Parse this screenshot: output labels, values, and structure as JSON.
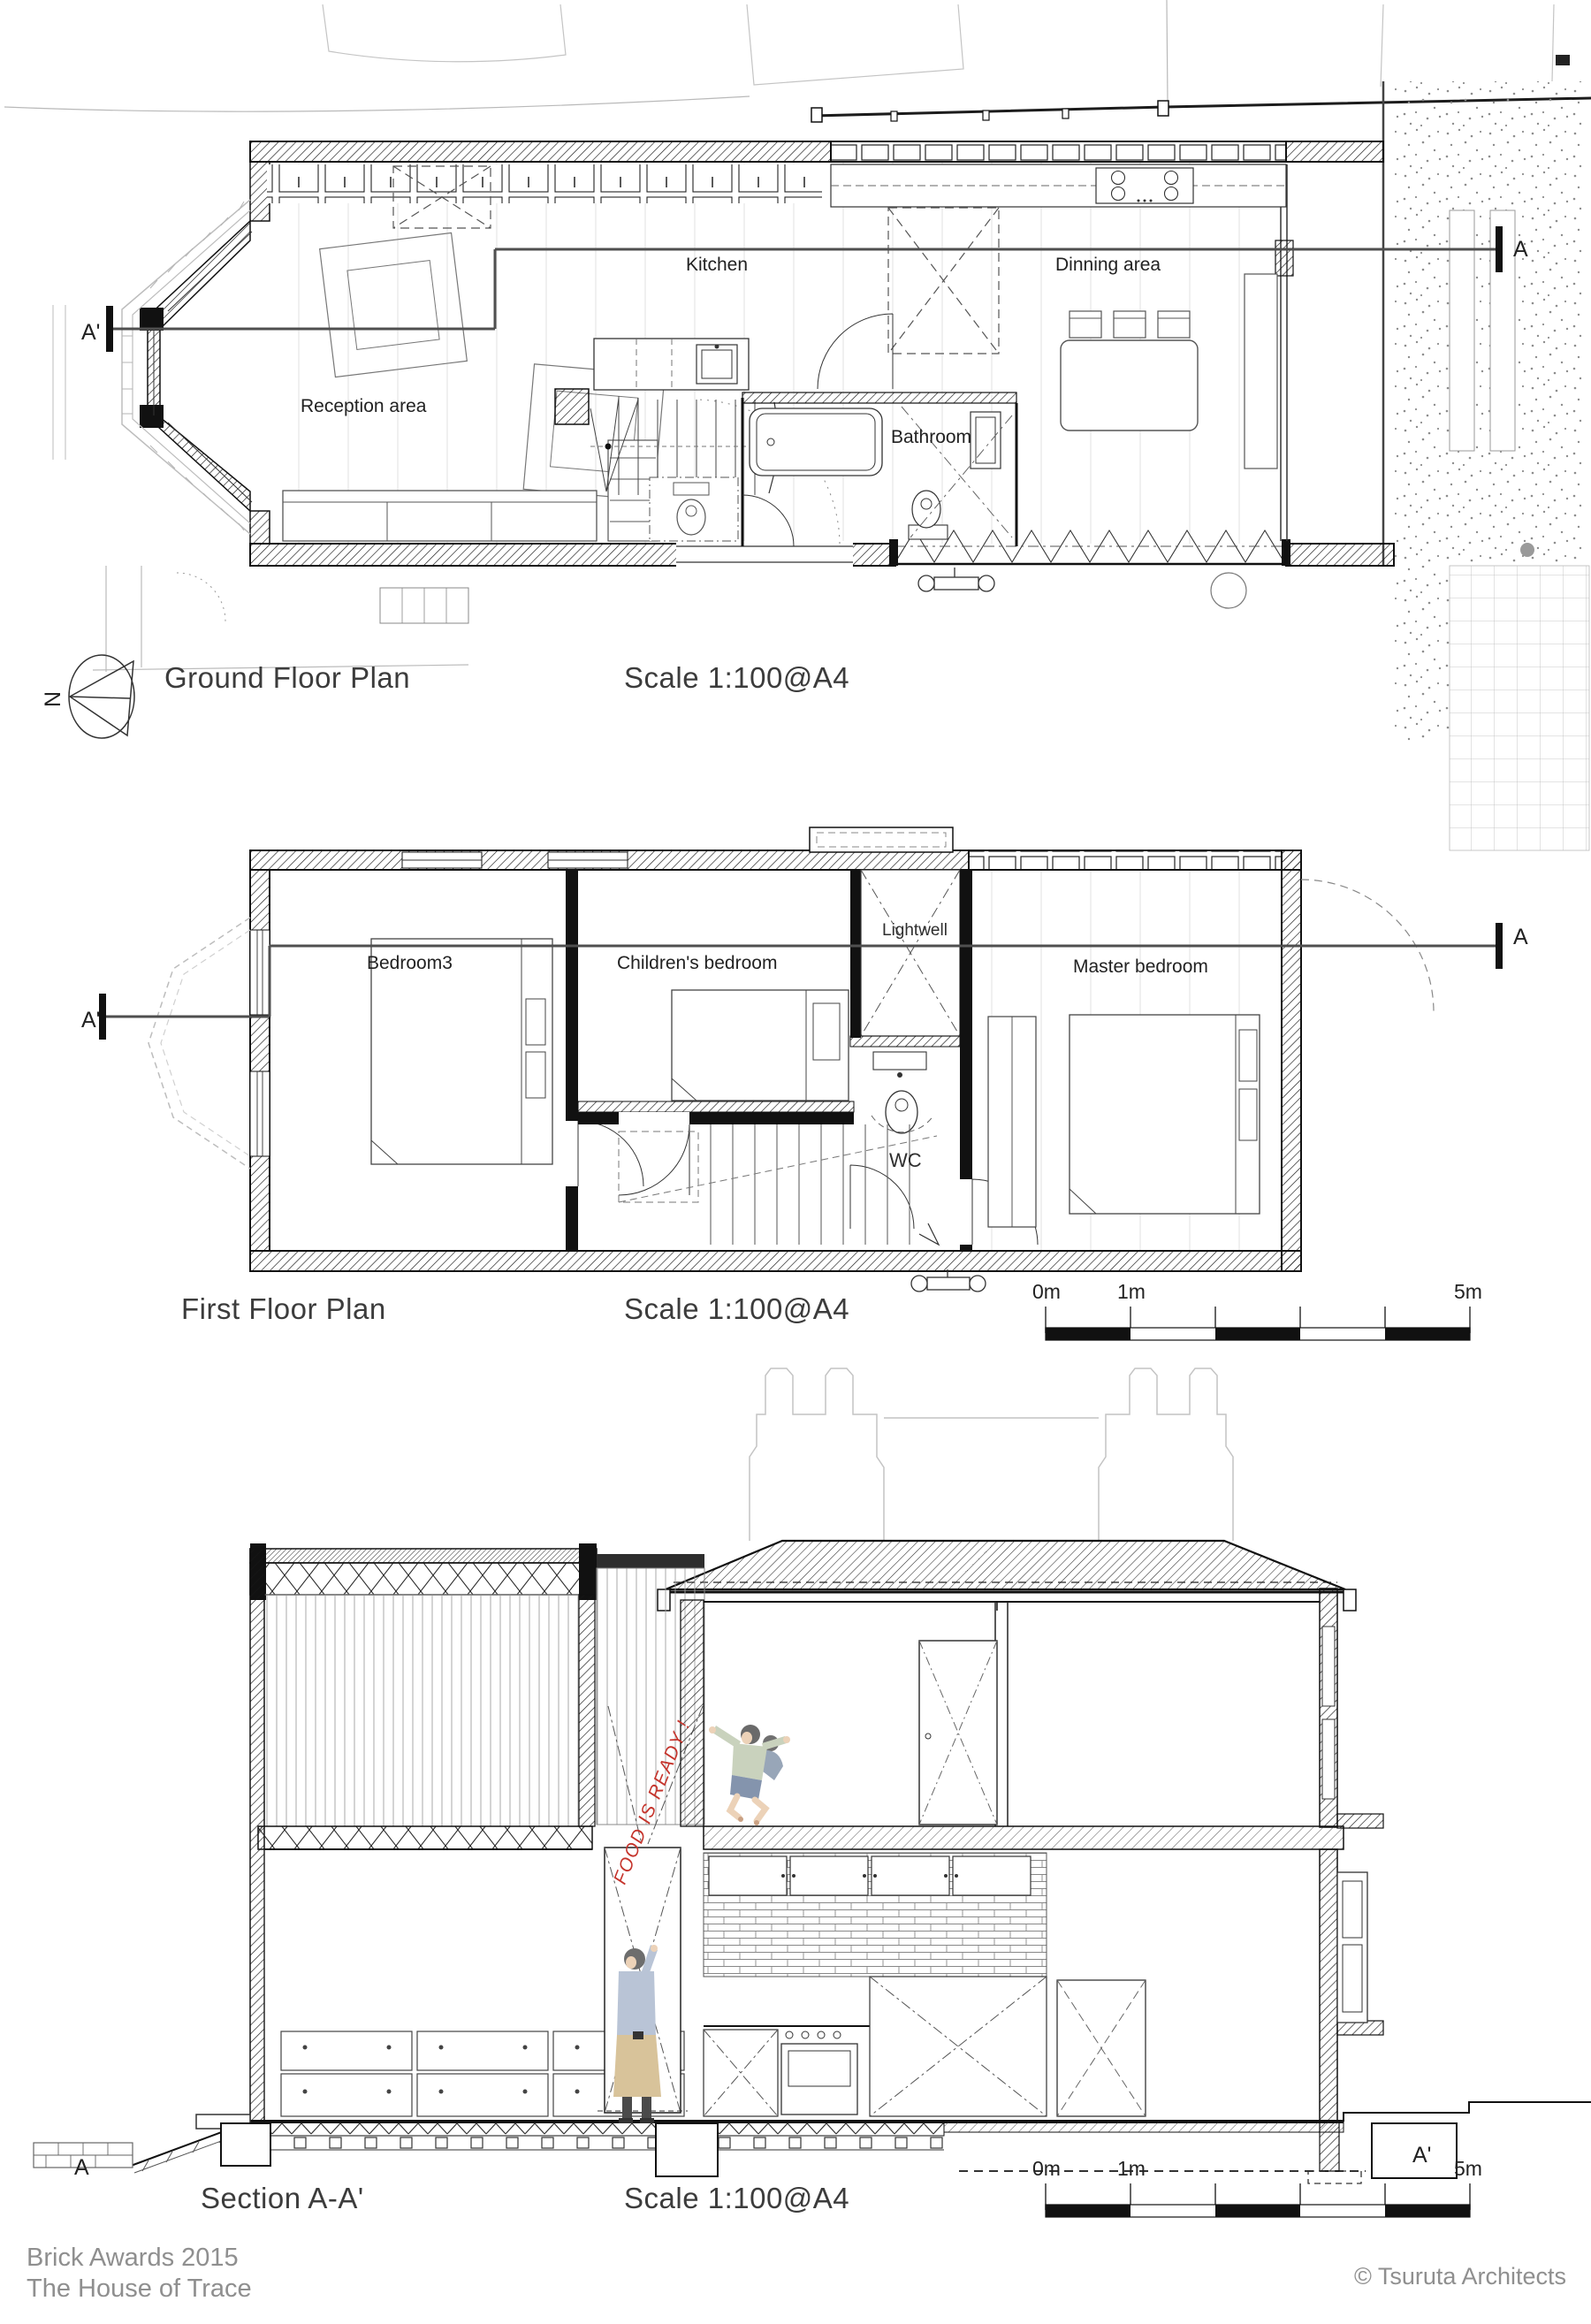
{
  "page": {
    "background": "#ffffff"
  },
  "colors": {
    "line": "#1a1a1a",
    "section_line": "#4f4f4f",
    "annotation_red": "#c5342c",
    "muted_text": "#8f8f8f",
    "context_gray": "#c4c4c4"
  },
  "ground_floor": {
    "title": "Ground Floor Plan",
    "scale_note": "Scale 1:100@A4",
    "north_label": "N",
    "rooms": {
      "kitchen": "Kitchen",
      "dining": "Dinning area",
      "reception": "Reception area",
      "bathroom": "Bathroom"
    },
    "section_markers": {
      "left": "A'",
      "right": "A"
    }
  },
  "first_floor": {
    "title": "First Floor Plan",
    "scale_note": "Scale 1:100@A4",
    "rooms": {
      "bedroom3": "Bedroom3",
      "childrens_bedroom": "Children's bedroom",
      "lightwell": "Lightwell",
      "master_bedroom": "Master bedroom",
      "wc": "WC"
    },
    "section_markers": {
      "left": "A'",
      "right": "A"
    },
    "scale_bar": {
      "start": "0m",
      "first": "1m",
      "end": "5m"
    }
  },
  "section": {
    "title": "Section A-A'",
    "scale_note": "Scale 1:100@A4",
    "speech_annotation": "FOOD IS READY !",
    "section_markers": {
      "left": "A",
      "right": "A'"
    },
    "scale_bar": {
      "start": "0m",
      "first": "1m",
      "end": "5m"
    }
  },
  "footer": {
    "award": "Brick Awards 2015",
    "project": "The House of Trace",
    "credit": "© Tsuruta Architects"
  }
}
